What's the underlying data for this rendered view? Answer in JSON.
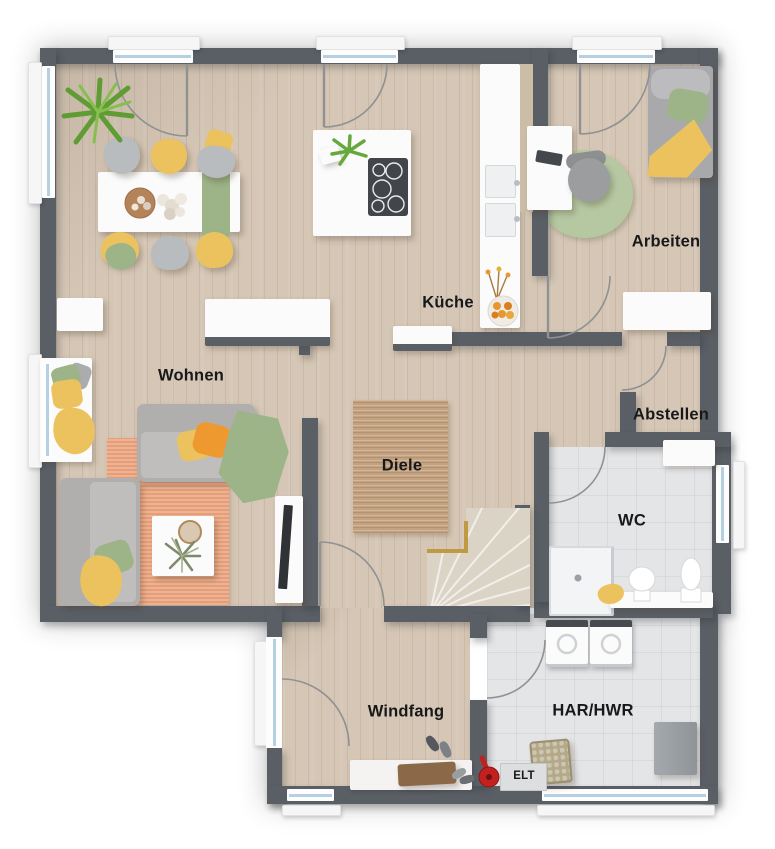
{
  "labels": {
    "wohnen": "Wohnen",
    "kueche": "Küche",
    "arbeiten": "Arbeiten",
    "abstellen": "Abstellen",
    "diele": "Diele",
    "wc": "WC",
    "windfang": "Windfang",
    "har": "HAR/HWR",
    "elt": "ELT"
  },
  "colors": {
    "wall": "#5a5f66",
    "floor_wood": "#d5c6b5",
    "floor_tile": "#e4e5e7",
    "rug_living": "#eda883",
    "rug_hall": "#c4a27f",
    "rug_office": "#b6c8a2",
    "sofa_gray": "#b0afad",
    "accent_yellow": "#ecc25e",
    "accent_green": "#9cb488",
    "accent_orange": "#ee9930",
    "stair_rail": "#c09a42",
    "window_glass": "#b5d0e0",
    "cooktop": "#42464b"
  }
}
